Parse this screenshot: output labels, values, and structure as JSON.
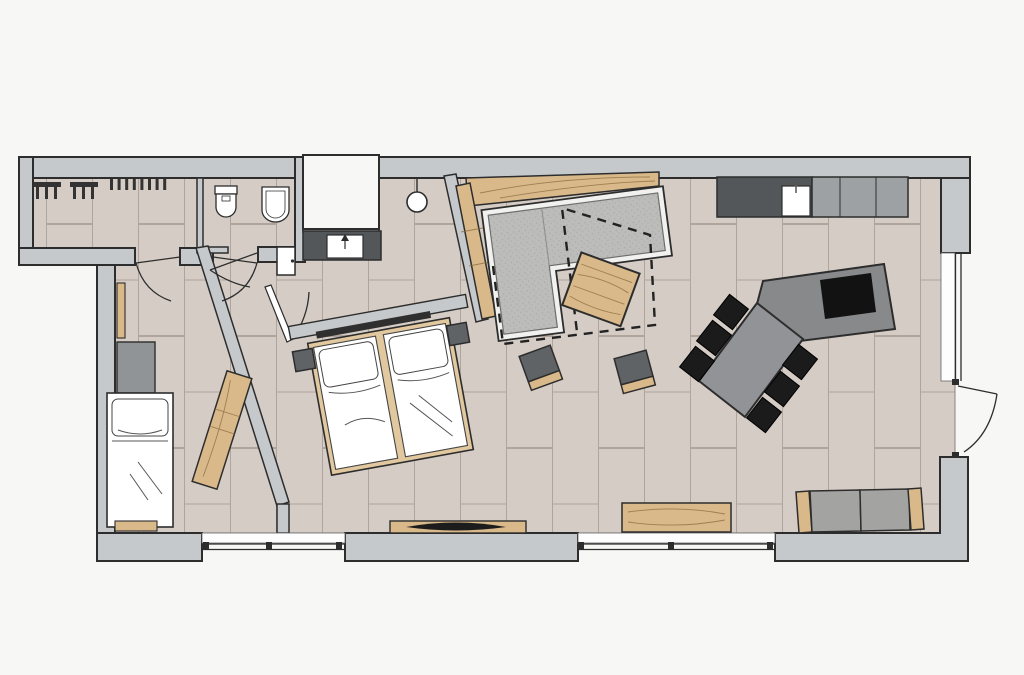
{
  "plan": {
    "kind": "apartment-floor-plan",
    "canvas": {
      "width": 1024,
      "height": 675
    },
    "rooms": [
      {
        "id": "entrance-hall",
        "features": [
          "coat-hook-rail-left",
          "coat-hook-rail-right",
          "door-to-child-room",
          "door-to-bedroom-corridor"
        ]
      },
      {
        "id": "bathroom",
        "features": [
          "toilet",
          "bidet",
          "swing-door",
          "closed-white-door"
        ]
      },
      {
        "id": "vanity-alcove",
        "features": [
          "dark-counter",
          "washbasin",
          "faucet-arrow",
          "pendant-lamp",
          "exterior-niche"
        ]
      },
      {
        "id": "child-room",
        "features": [
          "single-bed",
          "pillow",
          "wardrobe-cabinet",
          "wall-radiator",
          "angled-wardrobe",
          "under-bed-shelf"
        ]
      },
      {
        "id": "bedroom",
        "features": [
          "double-bed",
          "two-mattresses",
          "two-pillows",
          "headboard-panel",
          "headboard-light-bar",
          "nightstand-left",
          "nightstand-right",
          "tv-lowboard",
          "tv"
        ]
      },
      {
        "id": "living-room",
        "features": [
          "l-shaped-sofa",
          "sofa-platform",
          "wood-console-top",
          "wood-console-side",
          "rug-dashed-outline",
          "coffee-table",
          "pouf-left",
          "pouf-right",
          "wood-sideboard",
          "bench-with-armrests"
        ]
      },
      {
        "id": "kitchen-dining",
        "features": [
          "counter-dark",
          "counter-sink",
          "appliance-block",
          "island-with-cooktop",
          "dining-table",
          "six-black-chairs"
        ]
      }
    ],
    "openings": [
      "bottom-window-left",
      "bottom-window-right",
      "right-window",
      "balcony-door-swing-out",
      "hall-door-a",
      "hall-door-b",
      "bathroom-door",
      "corridor-door-leaf"
    ],
    "counts": {
      "dining_chairs": 6,
      "poufs": 2,
      "beds": 2,
      "windows": 3,
      "door_swings": 5
    }
  },
  "palette": {
    "outside": "#f7f7f5",
    "wall": "#c6c9cb",
    "wallStroke": "#2d2d2d",
    "floor": "#d4ccc5",
    "floorSeam": "#a89f96",
    "white": "#ffffff",
    "recess": "#fdfdfd",
    "wood": "#d9b98a",
    "woodLight": "#e2c89e",
    "woodDark": "#8a6b3f",
    "charcoal": "#53575a",
    "appliance": "#9da1a4",
    "sofa": "#bcbcba",
    "speckDot": "#a9a9a7",
    "platform": "#f1f1ef",
    "island": "#87898b",
    "tableTop": "#919396",
    "chair": "#1b1b1b",
    "cooktop": "#121212",
    "pouf": "#5f6365",
    "cabinet": "#909496",
    "bench": "#a3a3a1",
    "darkBar": "#2f2f2f",
    "hook": "#333333",
    "tv": "#1c1c1c"
  }
}
